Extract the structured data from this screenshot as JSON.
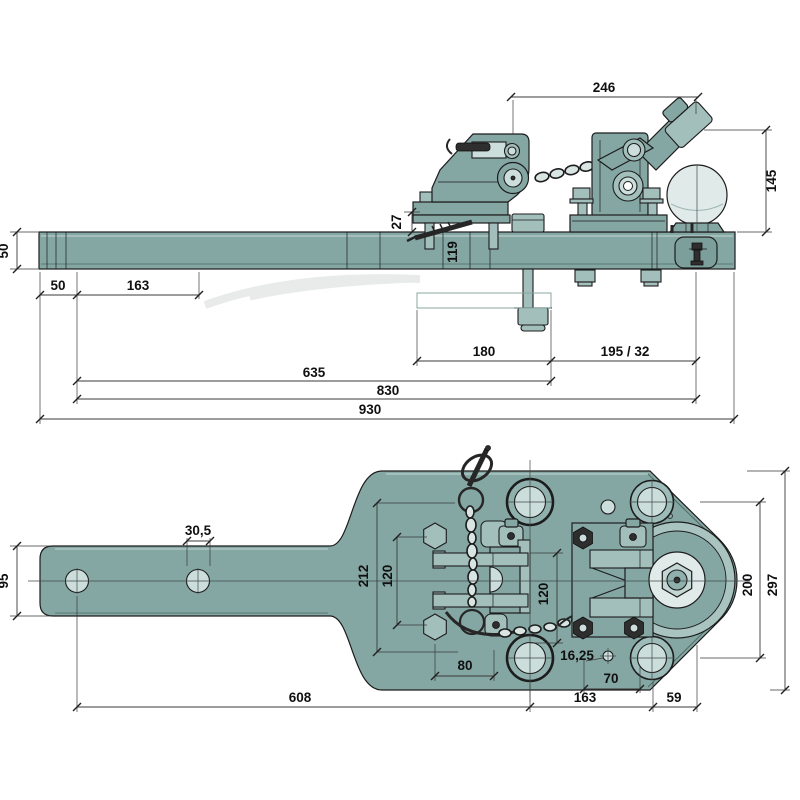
{
  "page": {
    "background": "#ffffff"
  },
  "drawing": {
    "kind": "technical dimension drawing",
    "subject": "tractor drawbar with clevis hitch, safety chain and tow ball",
    "views": [
      {
        "id": "side",
        "label": "side elevation"
      },
      {
        "id": "plan",
        "label": "plan view"
      }
    ],
    "colors": {
      "body": "#85a7a4",
      "body_mid": "#a3bfbc",
      "body_light": "#ccdedb",
      "ball": "#e0eae8",
      "hardware_dark": "#2e2e2e",
      "outline": "#1c1c1c",
      "dimension_lines": "#3a3a3a",
      "background": "#ffffff"
    },
    "side_dims": {
      "top_width": "246",
      "ball_height": "145",
      "plate_offset": "27",
      "bar_station": "119",
      "bar_height": "50",
      "end_offset": "50",
      "hole_pitch": "163",
      "plate_length": "180",
      "ball_setback": "195 / 32",
      "length_to_bolt": "635",
      "length_to_ball": "830",
      "overall_length": "930"
    },
    "plan_dims": {
      "hole_diameter": "30,5",
      "arm_width": "95",
      "head_width_outer": "212",
      "bolt_pitch_left": "120",
      "bolt_pitch_mid": "120",
      "hole_pitch_right": "200",
      "head_width": "297",
      "small_hole_diameter": "16,25",
      "bolt_pitch_bottom": "80",
      "small_hole_offset": "70",
      "length_to_centre": "608",
      "centre_to_hole": "163",
      "hole_to_edge": "59"
    }
  }
}
